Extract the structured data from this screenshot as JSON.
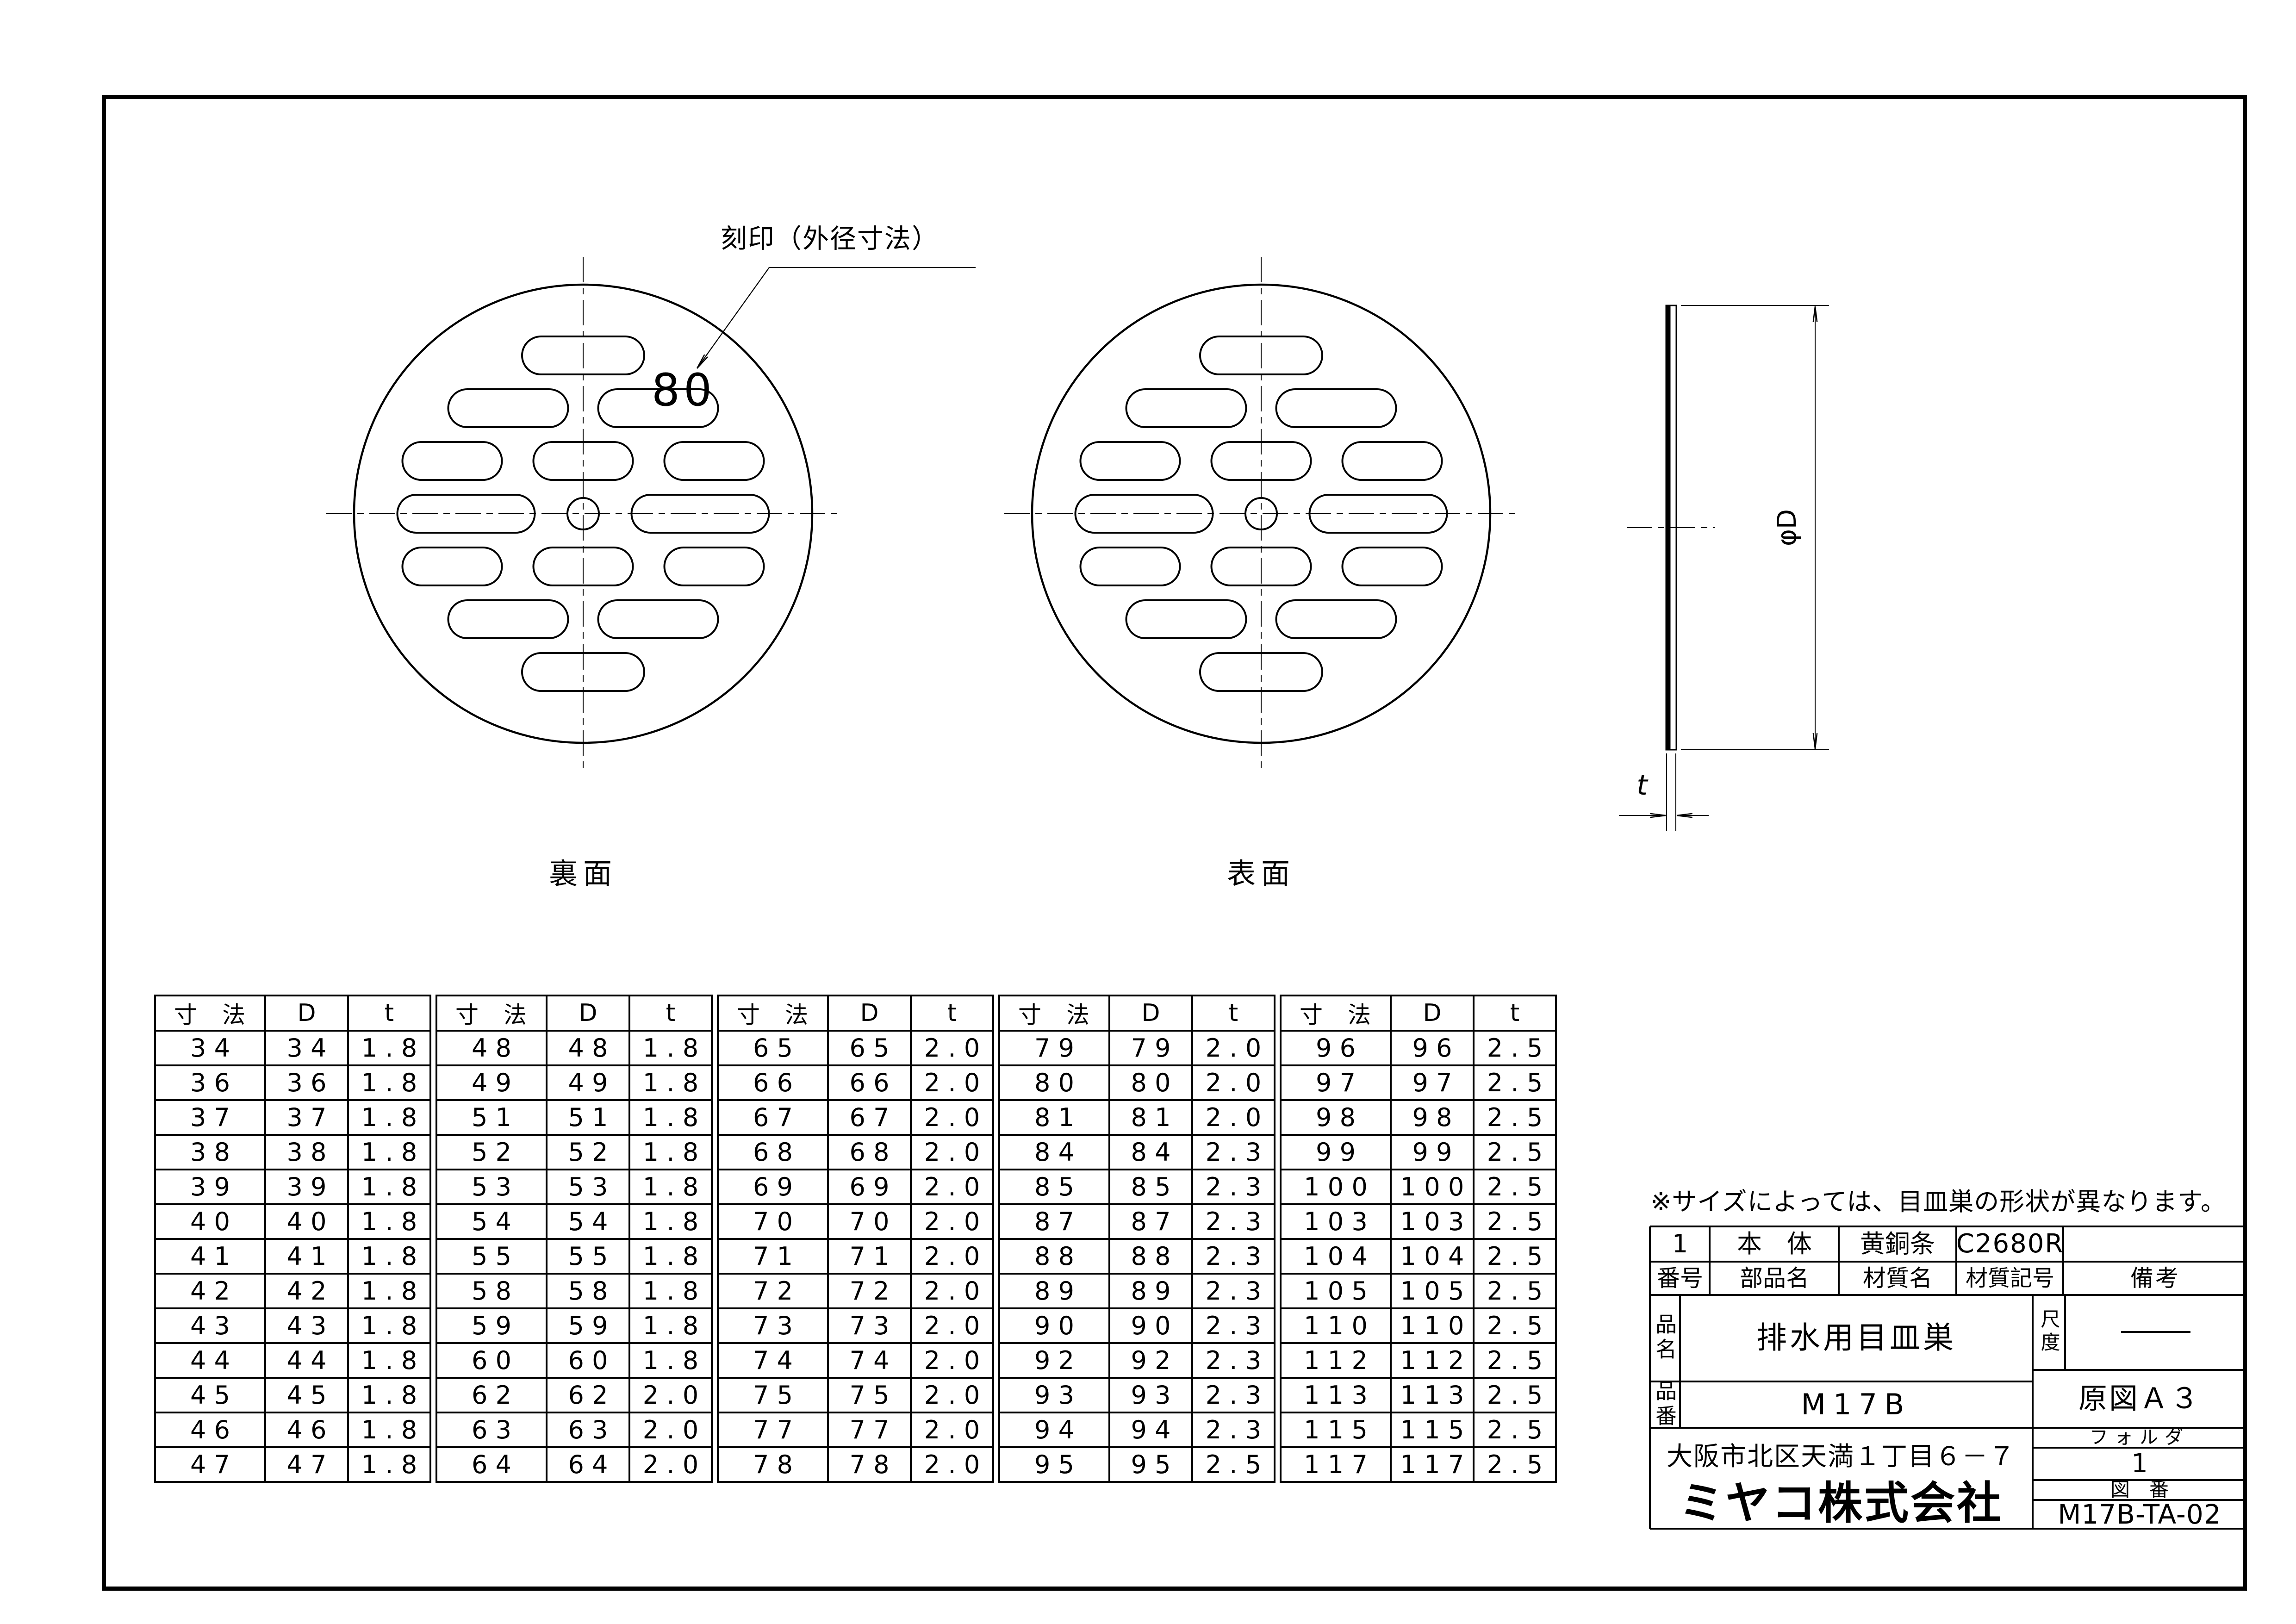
{
  "views": {
    "callout_label": "刻印（外径寸法）",
    "stamp_value": "80",
    "back_label": "裏面",
    "front_label": "表面",
    "diameter_dim_label": "φD",
    "thickness_dim_label": "t"
  },
  "note": "※サイズによっては、目皿巣の形状が異なります。",
  "dim_tables": {
    "headers": [
      "寸　法",
      "D",
      "t"
    ],
    "tables": [
      {
        "rows": [
          [
            "34",
            "34",
            "1.8"
          ],
          [
            "36",
            "36",
            "1.8"
          ],
          [
            "37",
            "37",
            "1.8"
          ],
          [
            "38",
            "38",
            "1.8"
          ],
          [
            "39",
            "39",
            "1.8"
          ],
          [
            "40",
            "40",
            "1.8"
          ],
          [
            "41",
            "41",
            "1.8"
          ],
          [
            "42",
            "42",
            "1.8"
          ],
          [
            "43",
            "43",
            "1.8"
          ],
          [
            "44",
            "44",
            "1.8"
          ],
          [
            "45",
            "45",
            "1.8"
          ],
          [
            "46",
            "46",
            "1.8"
          ],
          [
            "47",
            "47",
            "1.8"
          ]
        ]
      },
      {
        "rows": [
          [
            "48",
            "48",
            "1.8"
          ],
          [
            "49",
            "49",
            "1.8"
          ],
          [
            "51",
            "51",
            "1.8"
          ],
          [
            "52",
            "52",
            "1.8"
          ],
          [
            "53",
            "53",
            "1.8"
          ],
          [
            "54",
            "54",
            "1.8"
          ],
          [
            "55",
            "55",
            "1.8"
          ],
          [
            "58",
            "58",
            "1.8"
          ],
          [
            "59",
            "59",
            "1.8"
          ],
          [
            "60",
            "60",
            "1.8"
          ],
          [
            "62",
            "62",
            "2.0"
          ],
          [
            "63",
            "63",
            "2.0"
          ],
          [
            "64",
            "64",
            "2.0"
          ]
        ]
      },
      {
        "rows": [
          [
            "65",
            "65",
            "2.0"
          ],
          [
            "66",
            "66",
            "2.0"
          ],
          [
            "67",
            "67",
            "2.0"
          ],
          [
            "68",
            "68",
            "2.0"
          ],
          [
            "69",
            "69",
            "2.0"
          ],
          [
            "70",
            "70",
            "2.0"
          ],
          [
            "71",
            "71",
            "2.0"
          ],
          [
            "72",
            "72",
            "2.0"
          ],
          [
            "73",
            "73",
            "2.0"
          ],
          [
            "74",
            "74",
            "2.0"
          ],
          [
            "75",
            "75",
            "2.0"
          ],
          [
            "77",
            "77",
            "2.0"
          ],
          [
            "78",
            "78",
            "2.0"
          ]
        ]
      },
      {
        "rows": [
          [
            "79",
            "79",
            "2.0"
          ],
          [
            "80",
            "80",
            "2.0"
          ],
          [
            "81",
            "81",
            "2.0"
          ],
          [
            "84",
            "84",
            "2.3"
          ],
          [
            "85",
            "85",
            "2.3"
          ],
          [
            "87",
            "87",
            "2.3"
          ],
          [
            "88",
            "88",
            "2.3"
          ],
          [
            "89",
            "89",
            "2.3"
          ],
          [
            "90",
            "90",
            "2.3"
          ],
          [
            "92",
            "92",
            "2.3"
          ],
          [
            "93",
            "93",
            "2.3"
          ],
          [
            "94",
            "94",
            "2.3"
          ],
          [
            "95",
            "95",
            "2.5"
          ]
        ]
      },
      {
        "rows": [
          [
            "96",
            "96",
            "2.5"
          ],
          [
            "97",
            "97",
            "2.5"
          ],
          [
            "98",
            "98",
            "2.5"
          ],
          [
            "99",
            "99",
            "2.5"
          ],
          [
            "100",
            "100",
            "2.5"
          ],
          [
            "103",
            "103",
            "2.5"
          ],
          [
            "104",
            "104",
            "2.5"
          ],
          [
            "105",
            "105",
            "2.5"
          ],
          [
            "110",
            "110",
            "2.5"
          ],
          [
            "112",
            "112",
            "2.5"
          ],
          [
            "113",
            "113",
            "2.5"
          ],
          [
            "115",
            "115",
            "2.5"
          ],
          [
            "117",
            "117",
            "2.5"
          ]
        ]
      }
    ]
  },
  "title_block": {
    "parts_row": {
      "no": "1",
      "part_name": "本　体",
      "material_name": "黄銅条",
      "material_code": "C2680R",
      "remarks": ""
    },
    "header_row": {
      "no": "番号",
      "part_name": "部品名",
      "material_name": "材質名",
      "material_code": "材質記号",
      "remarks": "備考"
    },
    "product_name_label": "品名",
    "product_name": "排水用目皿巣",
    "product_no_label": "品番",
    "product_no": "M17B",
    "scale_label": "尺度",
    "original_size": "原図Ａ３",
    "address": "大阪市北区天満１丁目６－７",
    "company": "ミヤコ株式会社",
    "folder_label": "フォルダ",
    "folder_value": "1",
    "drawing_no_label": "図　番",
    "drawing_no": "M17B-TA-02"
  }
}
